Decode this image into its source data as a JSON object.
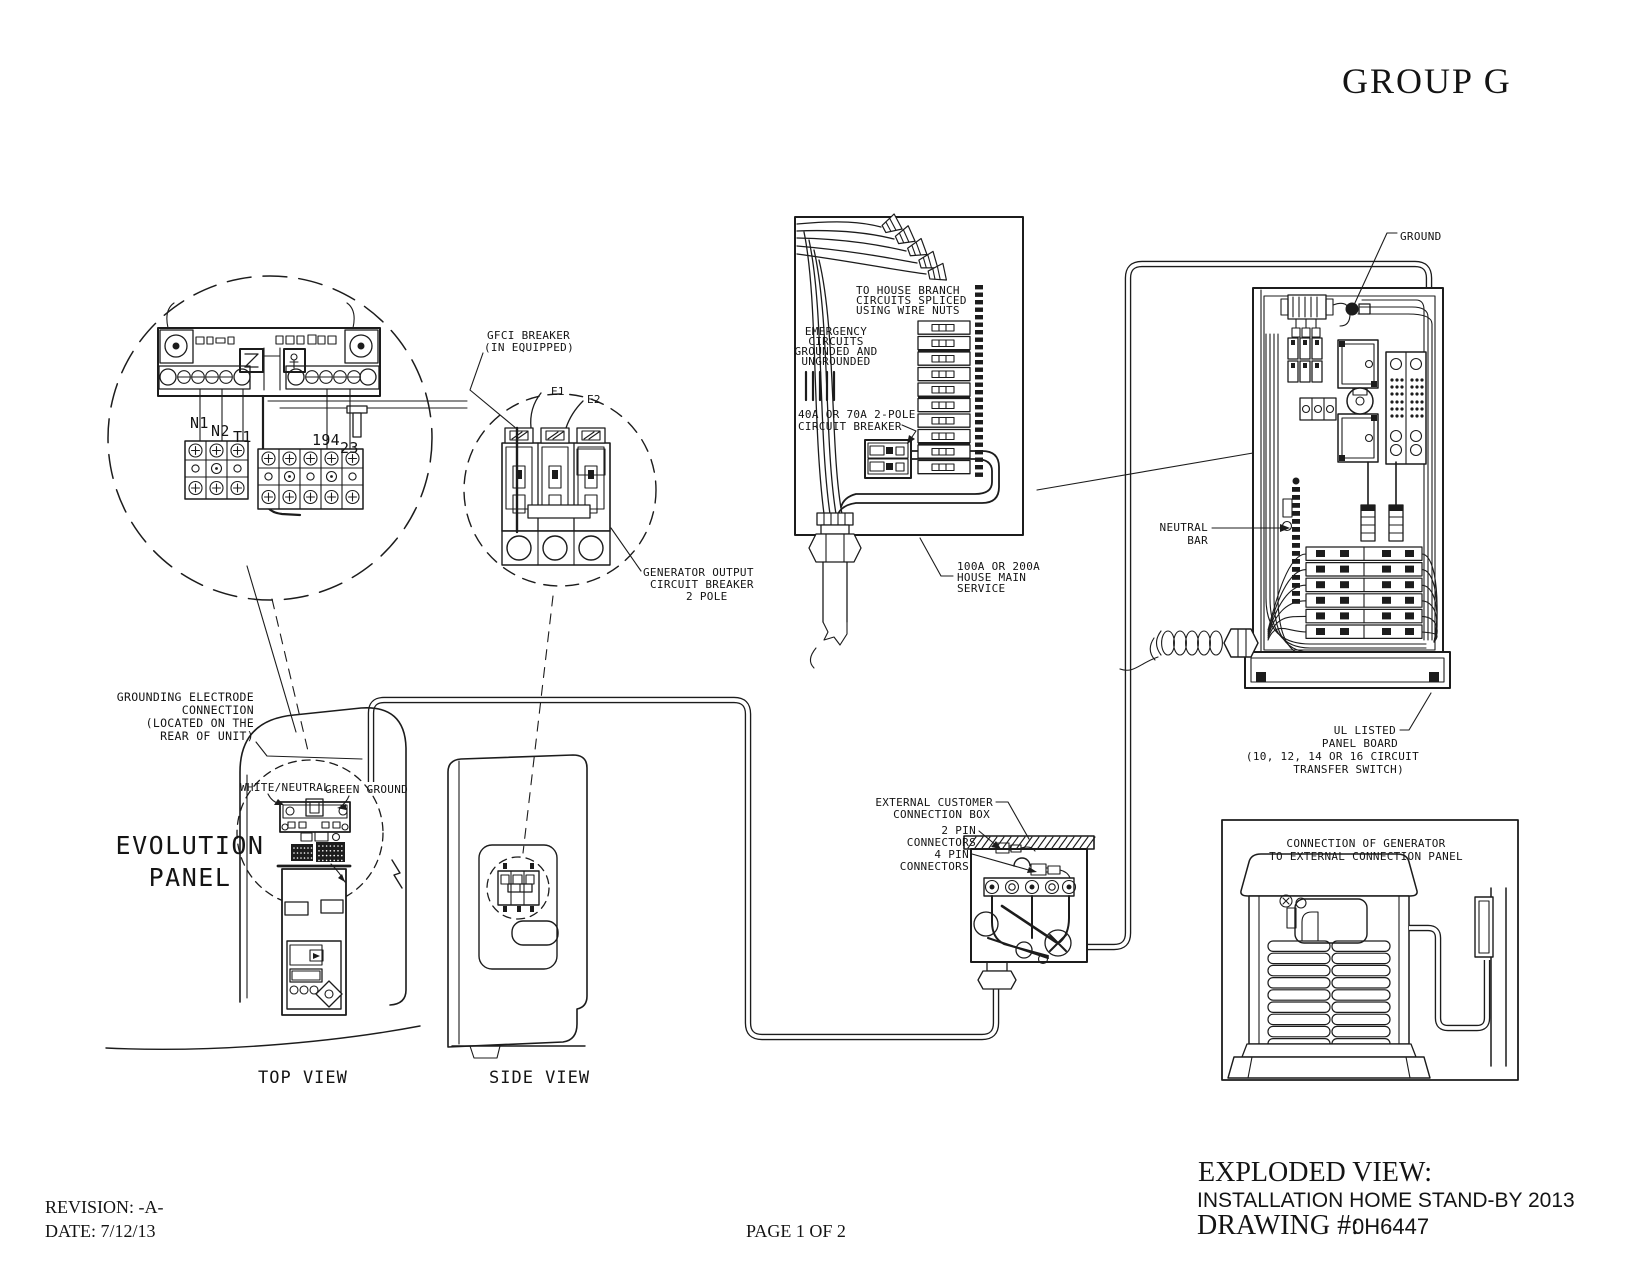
{
  "canvas": {
    "width": 1651,
    "height": 1275,
    "background": "#ffffff",
    "line_color": "#1c1c1c"
  },
  "titleblock": {
    "group": "GROUP G",
    "exploded_view": "EXPLODED VIEW:",
    "installation": "INSTALLATION HOME STAND-BY 2013",
    "drawing_label": "DRAWING #:",
    "drawing_number": "0H6447",
    "revision": "REVISION: -A-",
    "date": "DATE: 7/12/13",
    "page": "PAGE 1 OF 2"
  },
  "labels": {
    "terminal": {
      "n1": "N1",
      "n2": "N2",
      "t1": "T1",
      "x194": "194",
      "x23": "23"
    },
    "gfci": [
      "GFCI BREAKER",
      "(IN EQUIPPED)"
    ],
    "e1": "E1",
    "e2": "E2",
    "gen_output": [
      "GENERATOR OUTPUT",
      "CIRCUIT BREAKER",
      "2 POLE"
    ],
    "house_branch": [
      "TO HOUSE BRANCH",
      "CIRCUITS SPLICED",
      "USING WIRE NUTS"
    ],
    "emergency": [
      "EMERGENCY",
      "CIRCUITS",
      "GROUNDED AND",
      "UNGROUNDED"
    ],
    "pole_breaker": [
      "40A OR 70A 2-POLE",
      "CIRCUIT BREAKER"
    ],
    "house_main": [
      "100A OR 200A",
      "HOUSE MAIN",
      "SERVICE"
    ],
    "ground": "GROUND",
    "neutral_bar": [
      "NEUTRAL",
      "BAR"
    ],
    "ul_listed": [
      "UL LISTED",
      "PANEL BOARD",
      "(10, 12, 14 OR 16 CIRCUIT",
      "TRANSFER SWITCH)"
    ],
    "grounding_electrode": [
      "GROUNDING ELECTRODE",
      "CONNECTION",
      "(LOCATED ON THE",
      "REAR OF UNIT)"
    ],
    "white_neutral": "WHITE/NEUTRAL",
    "green_ground": "GREEN GROUND",
    "evolution": [
      "EVOLUTION",
      "PANEL"
    ],
    "top_view": "TOP VIEW",
    "side_view": "SIDE VIEW",
    "external_box": [
      "EXTERNAL CUSTOMER",
      "CONNECTION BOX"
    ],
    "pin2": [
      "2 PIN",
      "CONNECTORS"
    ],
    "pin4": [
      "4 PIN",
      "CONNECTORS"
    ],
    "generator_connection": [
      "CONNECTION OF GENERATOR",
      "TO EXTERNAL CONNECTION PANEL"
    ]
  }
}
